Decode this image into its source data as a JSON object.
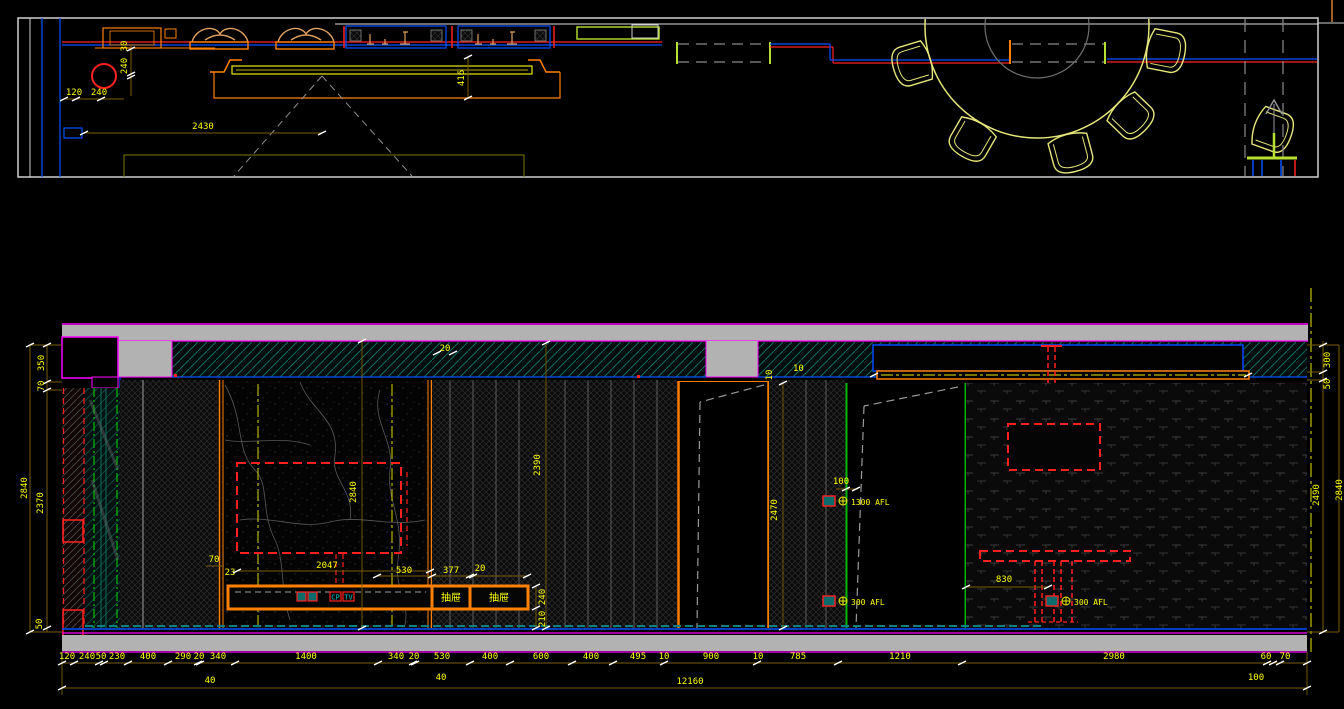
{
  "plan": {
    "dims": [
      "120",
      "240",
      "240",
      "30",
      "2430",
      "416"
    ]
  },
  "elevation": {
    "left_dims": [
      "350",
      "70",
      "2840",
      "2370",
      "50"
    ],
    "right_dims": [
      "300",
      "50",
      "2490",
      "2840"
    ],
    "inner_dims": [
      "2840",
      "2390",
      "2470",
      "10",
      "10",
      "20",
      "100",
      "830",
      "240",
      "210",
      "70",
      "23",
      "2047",
      "530",
      "377",
      "20"
    ],
    "row1": [
      "120",
      "240",
      "50",
      "230",
      "400",
      "290",
      "20",
      "340",
      "1400",
      "340",
      "20",
      "530",
      "400",
      "600",
      "400",
      "495",
      "10",
      "900",
      "10",
      "785",
      "1210",
      "2980",
      "60",
      "70"
    ],
    "row2": [
      "40",
      "40",
      "100"
    ],
    "total": "12160",
    "labels": {
      "drawer_left": "抽屉",
      "drawer_right": "抽屉",
      "cp": "CP",
      "tv": "TV",
      "switch_height": "1300 AFL",
      "socket_height_door": "300 AFL",
      "socket_height_table": "300 AFL"
    }
  }
}
